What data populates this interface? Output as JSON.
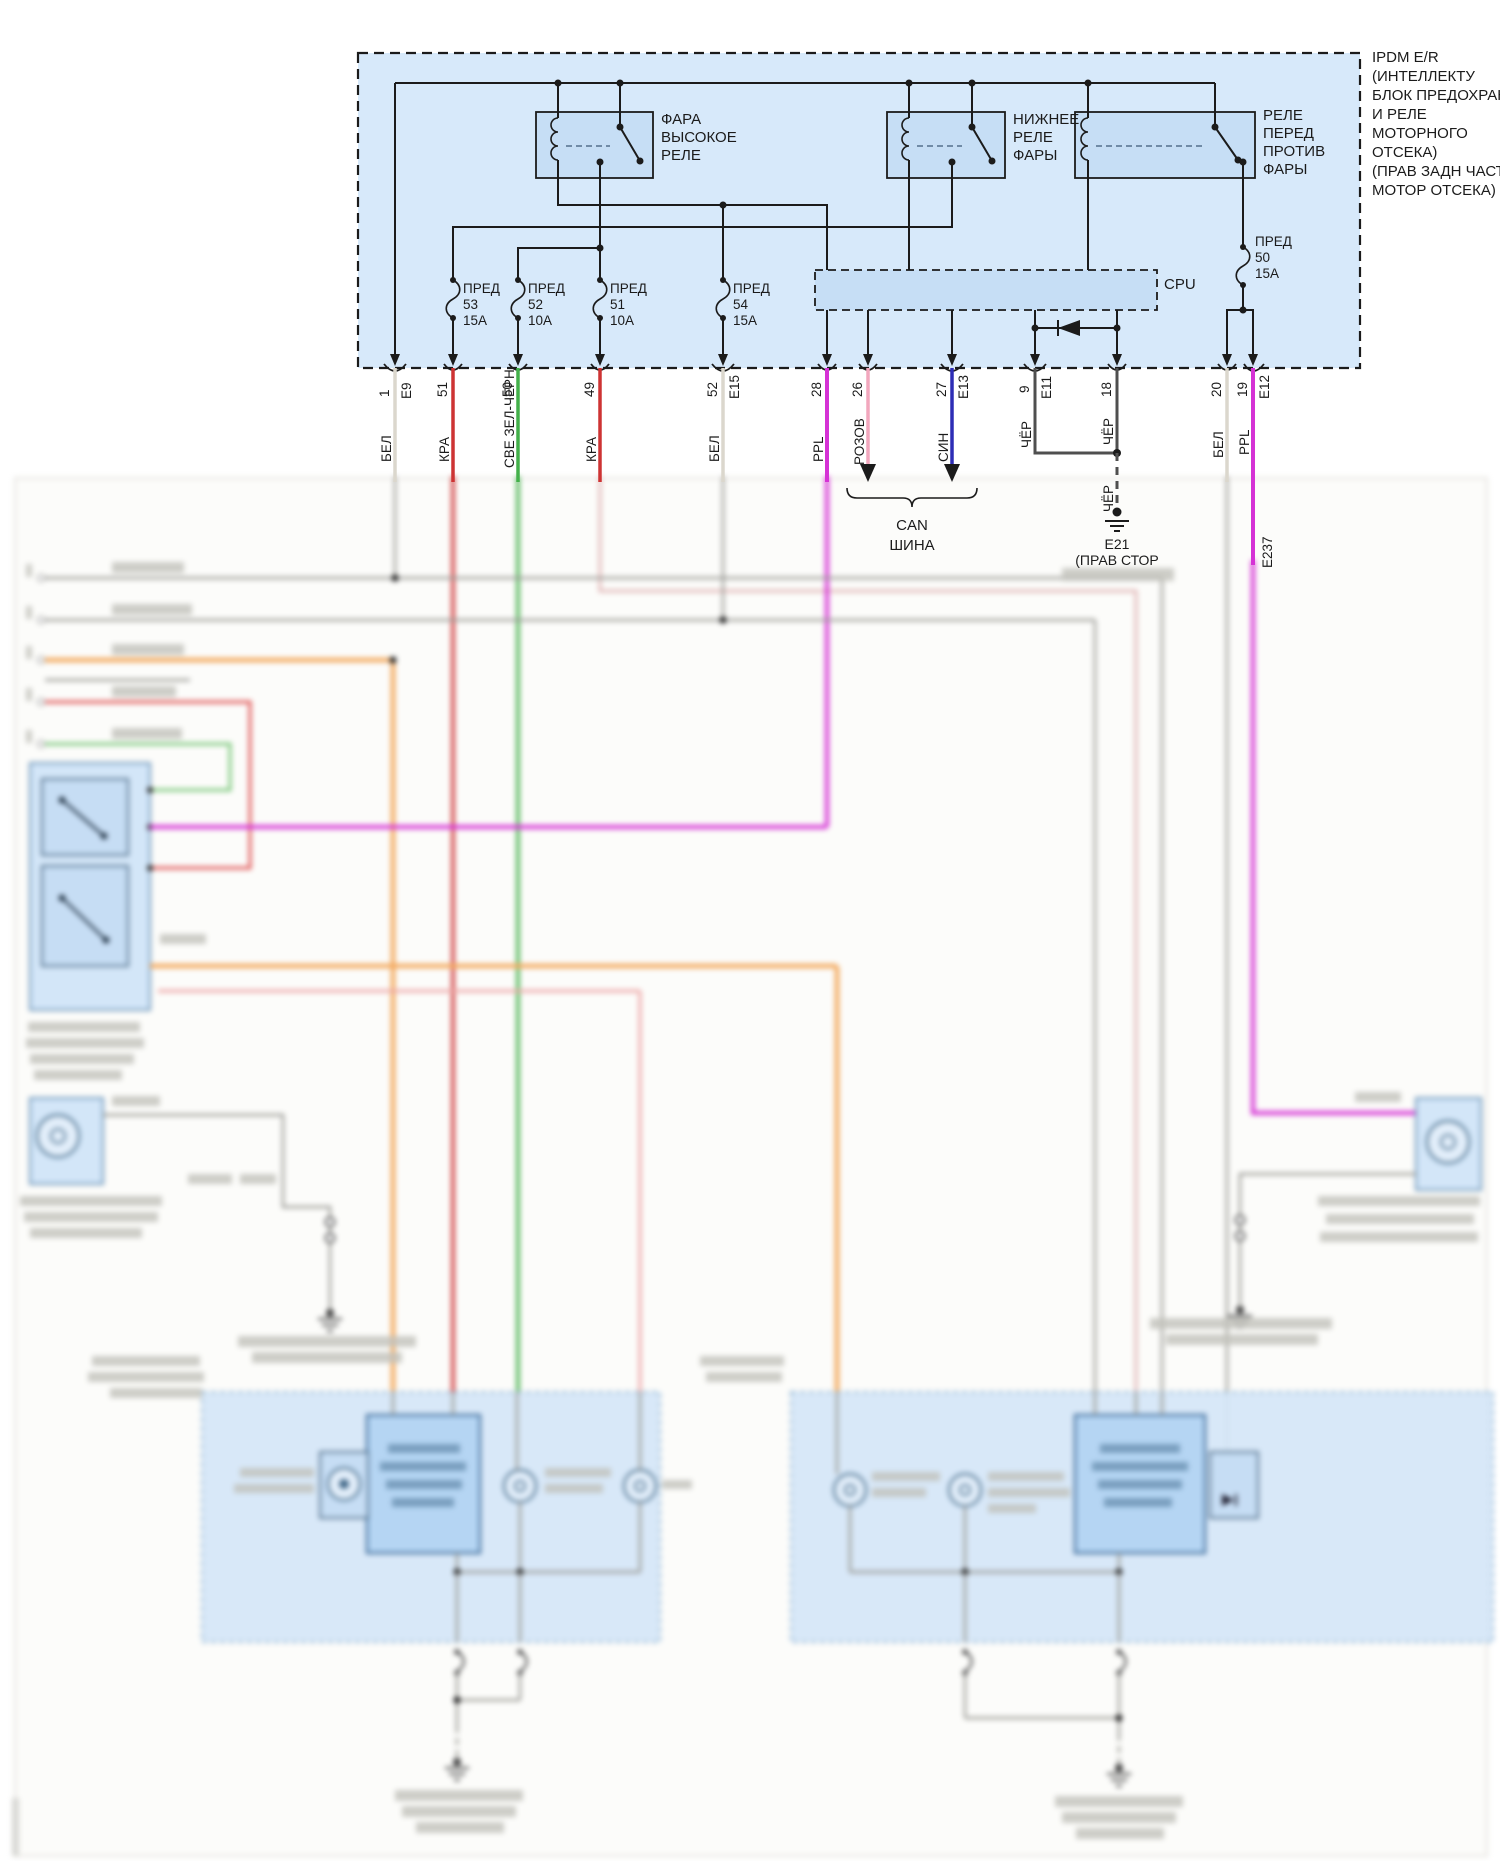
{
  "diagram": {
    "ipdm_title": [
      "IPDM E/R",
      "(ИНТЕЛЛЕКТУ",
      "БЛОК ПРЕДОХРАНИТ",
      "И РЕЛЕ",
      "МОТОРНОГО",
      "ОТСЕКА)",
      "(ПРАВ ЗАДН ЧАСТЬ",
      "МОТОР ОТСЕКА)"
    ],
    "relays": {
      "high": [
        "ФАРА",
        "ВЫСОКОЕ",
        "РЕЛЕ"
      ],
      "low": [
        "НИЖНЕЕ",
        "РЕЛЕ",
        "ФАРЫ"
      ],
      "fog": [
        "РЕЛЕ",
        "ПЕРЕД",
        "ПРОТИВ",
        "ФАРЫ"
      ]
    },
    "cpu": "CPU",
    "fuses": {
      "f53": [
        "ПРЕД",
        "53",
        "15А"
      ],
      "f52": [
        "ПРЕД",
        "52",
        "10А"
      ],
      "f51": [
        "ПРЕД",
        "51",
        "10А"
      ],
      "f54": [
        "ПРЕД",
        "54",
        "15А"
      ],
      "f50": [
        "ПРЕД",
        "50",
        "15А"
      ]
    },
    "pins": {
      "p1": "1",
      "e9": "E9",
      "p51": "51",
      "p50": "50",
      "p49": "49",
      "p52": "52",
      "e15": "E15",
      "p28": "28",
      "p26": "26",
      "p27": "27",
      "e13": "E13",
      "p9": "9",
      "e11": "E11",
      "p18": "18",
      "p20": "20",
      "p19": "19",
      "e12": "E12"
    },
    "wire_colors": {
      "bel": "БЕЛ",
      "kra": "КРА",
      "sve_zel_chern": "СВЕ ЗЕЛ-ЧЕРН",
      "ppl": "PPL",
      "rozov": "РОЗОВ",
      "sin": "СИН",
      "cher": "ЧЁР"
    },
    "can_bus": [
      "CAN",
      "ШИНА"
    ],
    "ground_e21": {
      "id": "E21",
      "loc": "(ПРАВ СТОР"
    },
    "connector_e237": "E237"
  },
  "colors": {
    "panel": "#d7e9fa",
    "relay_fill": "#c6def5",
    "wire_bel": "#dbd7cd",
    "wire_kra": "#cd3333",
    "wire_green": "#43b04a",
    "wire_ppl": "#d532d5",
    "wire_rozov": "#f2a7bd",
    "wire_sin": "#2d2db5",
    "wire_cher": "#4f4f4f",
    "wire_orange": "#f3a95e",
    "wire_salmon": "#eda6a6"
  }
}
